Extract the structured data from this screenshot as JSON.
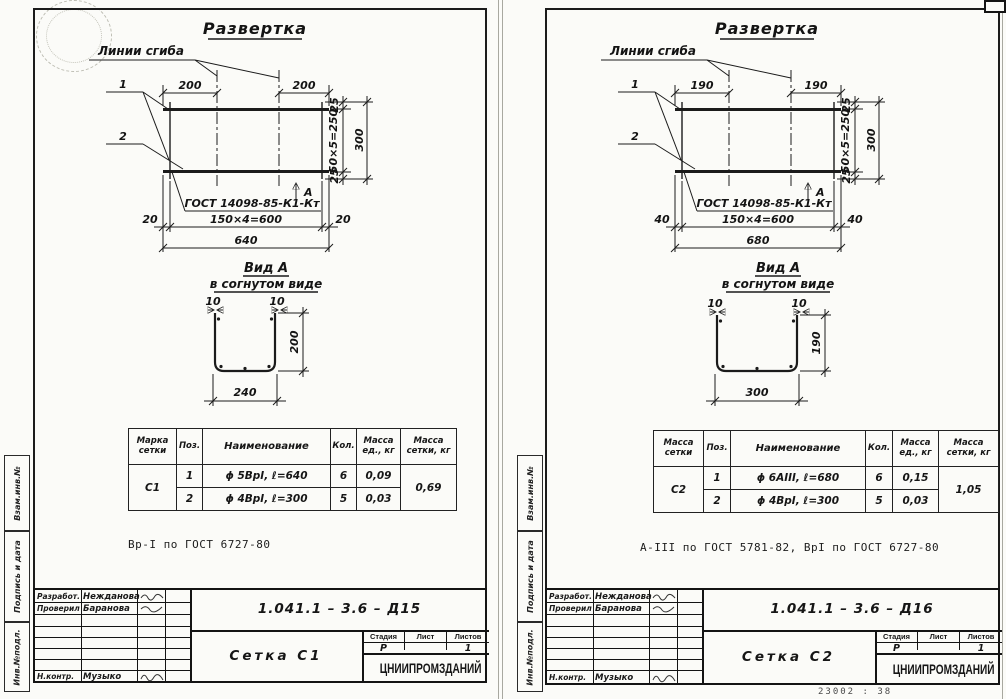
{
  "footer_note": "23002 :  38",
  "sheets": [
    {
      "dev_title": "Развертка",
      "fold_label": "Линии сгиба",
      "pos1": "1",
      "pos2": "2",
      "weld_label": "ГОСТ 14098-85-К1-Кт",
      "view_marker": "А",
      "dims": {
        "top_left": "200",
        "top_right": "200",
        "side_a": "25",
        "side_mid": "50×5=250",
        "side_b": "25",
        "side_total": "300",
        "bot_left": "20",
        "bot_mid": "150×4=600",
        "bot_right": "20",
        "bot_total": "640"
      },
      "view": {
        "title": "Вид А",
        "subtitle": "в согнутом виде",
        "edge_left": "10",
        "edge_right": "10",
        "height": "200",
        "width": "240"
      },
      "table": {
        "h_mark": "Марка сетки",
        "h_pos": "Поз.",
        "h_name": "Наименование",
        "h_qty": "Кол.",
        "h_mass": "Масса ед., кг",
        "h_mass_total": "Масса сетки, кг",
        "mark": "С1",
        "rows": [
          {
            "pos": "1",
            "name": "ϕ 5ВрI, ℓ=640",
            "qty": "6",
            "mass": "0,09"
          },
          {
            "pos": "2",
            "name": "ϕ 4ВрI, ℓ=300",
            "qty": "5",
            "mass": "0,03"
          }
        ],
        "total_mass": "0,69"
      },
      "note": "Вр-I по ГОСТ 6727-80",
      "titleblock": {
        "developed_label": "Разработ.",
        "developed_by": "Нежданова",
        "checked_label": "Проверил",
        "checked_by": "Баранова",
        "ncontrol_label": "Н.контр.",
        "ncontrol_by": "Музыко",
        "doc_number": "1.041.1 – 3.6 – Д15",
        "title": "Сетка С1",
        "stage_label": "Стадия",
        "sheet_label": "Лист",
        "sheets_label": "Листов",
        "stage": "Р",
        "sheet": "",
        "sheets_count": "1",
        "org": "ЦНИИПРОМЗДАНИЙ"
      },
      "margins": [
        "Взам.инв.№",
        "Подпись и дата",
        "Инв.№подл."
      ]
    },
    {
      "dev_title": "Развертка",
      "fold_label": "Линии сгиба",
      "pos1": "1",
      "pos2": "2",
      "weld_label": "ГОСТ 14098-85-К1-Кт",
      "view_marker": "А",
      "dims": {
        "top_left": "190",
        "top_right": "190",
        "side_a": "25",
        "side_mid": "50×5=250",
        "side_b": "25",
        "side_total": "300",
        "bot_left": "40",
        "bot_mid": "150×4=600",
        "bot_right": "40",
        "bot_total": "680"
      },
      "view": {
        "title": "Вид А",
        "subtitle": "в согнутом виде",
        "edge_left": "10",
        "edge_right": "10",
        "height": "190",
        "width": "300"
      },
      "table": {
        "h_mark": "Масса сетки",
        "h_pos": "Поз.",
        "h_name": "Наименование",
        "h_qty": "Кол.",
        "h_mass": "Масса ед., кг",
        "h_mass_total": "Масса сетки, кг",
        "mark": "С2",
        "rows": [
          {
            "pos": "1",
            "name": "ϕ 6АIII, ℓ=680",
            "qty": "6",
            "mass": "0,15"
          },
          {
            "pos": "2",
            "name": "ϕ 4ВрI, ℓ=300",
            "qty": "5",
            "mass": "0,03"
          }
        ],
        "total_mass": "1,05"
      },
      "note": "А-III по ГОСТ 5781-82, ВрI по ГОСТ 6727-80",
      "titleblock": {
        "developed_label": "Разработ.",
        "developed_by": "Нежданова",
        "checked_label": "Проверил",
        "checked_by": "Баранова",
        "ncontrol_label": "Н.контр.",
        "ncontrol_by": "Музыко",
        "doc_number": "1.041.1 – 3.6 – Д16",
        "title": "Сетка С2",
        "stage_label": "Стадия",
        "sheet_label": "Лист",
        "sheets_label": "Листов",
        "stage": "Р",
        "sheet": "",
        "sheets_count": "1",
        "org": "ЦНИИПРОМЗДАНИЙ"
      },
      "margins": [
        "Взам.инв.№",
        "Подпись и дата",
        "Инв.№подл."
      ]
    }
  ]
}
